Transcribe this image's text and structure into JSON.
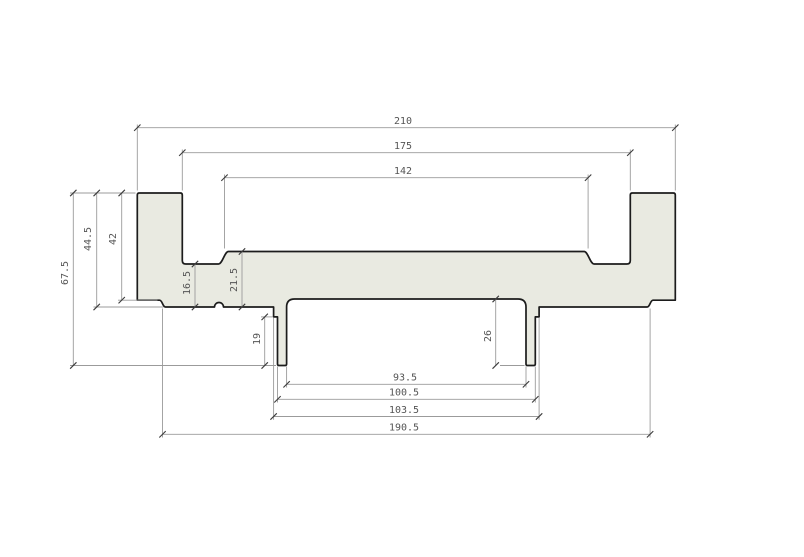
{
  "drawing": {
    "type": "technical-drawing-cross-section-profile",
    "canvas": {
      "width": 804,
      "height": 557,
      "background": "#ffffff"
    },
    "style": {
      "profile_fill": "#e9eae1",
      "outline_color": "#1c1c1c",
      "outline_width": 1.7,
      "dim_line_color": "#9b9b9b",
      "dim_line_width": 0.9,
      "tick_color": "#3c3c3c",
      "tick_size": 3.2,
      "text_color": "#555555",
      "font_size": 10
    },
    "dimensions": {
      "horizontal": [
        {
          "value": "210",
          "y": 127.7,
          "x1": 137.3,
          "x2": 675.3,
          "label_x": 403,
          "label_y": 124
        },
        {
          "value": "175",
          "y": 152.7,
          "x1": 182.3,
          "x2": 630.3,
          "label_x": 403,
          "label_y": 149
        },
        {
          "value": "142",
          "y": 177.7,
          "x1": 224.5,
          "x2": 588.1,
          "label_x": 403,
          "label_y": 174
        },
        {
          "value": "93.5",
          "y": 384.3,
          "x1": 286.6,
          "x2": 526.0,
          "label_x": 405,
          "label_y": 380.5
        },
        {
          "value": "100.5",
          "y": 399.3,
          "x1": 277.5,
          "x2": 535.3,
          "label_x": 404,
          "label_y": 395.5
        },
        {
          "value": "103.5",
          "y": 416.5,
          "x1": 273.6,
          "x2": 539.1,
          "label_x": 404,
          "label_y": 413
        },
        {
          "value": "190.5",
          "y": 434.3,
          "x1": 162.5,
          "x2": 650.1,
          "label_x": 404,
          "label_y": 430.5
        }
      ],
      "vertical": [
        {
          "value": "67.5",
          "x": 73.3,
          "y1": 193.0,
          "y2": 365.5,
          "label_x": 68,
          "label_y": 273
        },
        {
          "value": "44.5",
          "x": 96.7,
          "y1": 193.0,
          "y2": 307.0,
          "label_x": 91,
          "label_y": 239
        },
        {
          "value": "42",
          "x": 121.7,
          "y1": 193.0,
          "y2": 300.2,
          "label_x": 116,
          "label_y": 239
        },
        {
          "value": "16.5",
          "x": 195.0,
          "y1": 264.0,
          "y2": 307.0,
          "label_x": 190,
          "label_y": 283
        },
        {
          "value": "21.5",
          "x": 242.0,
          "y1": 251.5,
          "y2": 307.0,
          "label_x": 237,
          "label_y": 280
        },
        {
          "value": "19",
          "x": 264.7,
          "y1": 316.9,
          "y2": 365.5,
          "label_x": 260,
          "label_y": 339
        },
        {
          "value": "26",
          "x": 495.7,
          "y1": 299.0,
          "y2": 365.5,
          "label_x": 491,
          "label_y": 336
        }
      ]
    },
    "extension_lines": [
      {
        "x1": 137.3,
        "y1": 124.5,
        "x2": 137.3,
        "y2": 190.5
      },
      {
        "x1": 675.3,
        "y1": 124.5,
        "x2": 675.3,
        "y2": 190.5
      },
      {
        "x1": 182.3,
        "y1": 149.5,
        "x2": 182.3,
        "y2": 190.5
      },
      {
        "x1": 630.3,
        "y1": 149.5,
        "x2": 630.3,
        "y2": 190.5
      },
      {
        "x1": 224.5,
        "y1": 174.5,
        "x2": 224.5,
        "y2": 248.5
      },
      {
        "x1": 588.1,
        "y1": 174.5,
        "x2": 588.1,
        "y2": 248.5
      },
      {
        "x1": 70.0,
        "y1": 193.0,
        "x2": 135.5,
        "y2": 193.0
      },
      {
        "x1": 118.0,
        "y1": 300.2,
        "x2": 157.5,
        "y2": 300.2
      },
      {
        "x1": 93.5,
        "y1": 307.0,
        "x2": 163.5,
        "y2": 307.0
      },
      {
        "x1": 70.0,
        "y1": 365.5,
        "x2": 276.0,
        "y2": 365.5
      },
      {
        "x1": 261.0,
        "y1": 316.9,
        "x2": 272.5,
        "y2": 316.9
      },
      {
        "x1": 500.0,
        "y1": 365.5,
        "x2": 524.5,
        "y2": 365.5
      },
      {
        "x1": 286.6,
        "y1": 366.5,
        "x2": 286.6,
        "y2": 387.5
      },
      {
        "x1": 526.0,
        "y1": 366.5,
        "x2": 526.0,
        "y2": 387.5
      },
      {
        "x1": 277.5,
        "y1": 366.5,
        "x2": 277.5,
        "y2": 402.5
      },
      {
        "x1": 535.3,
        "y1": 366.5,
        "x2": 535.3,
        "y2": 402.5
      },
      {
        "x1": 273.6,
        "y1": 318.0,
        "x2": 273.6,
        "y2": 419.8
      },
      {
        "x1": 539.1,
        "y1": 318.0,
        "x2": 539.1,
        "y2": 419.8
      },
      {
        "x1": 162.5,
        "y1": 308.5,
        "x2": 162.5,
        "y2": 437.5
      },
      {
        "x1": 650.1,
        "y1": 308.5,
        "x2": 650.1,
        "y2": 437.5
      }
    ]
  }
}
